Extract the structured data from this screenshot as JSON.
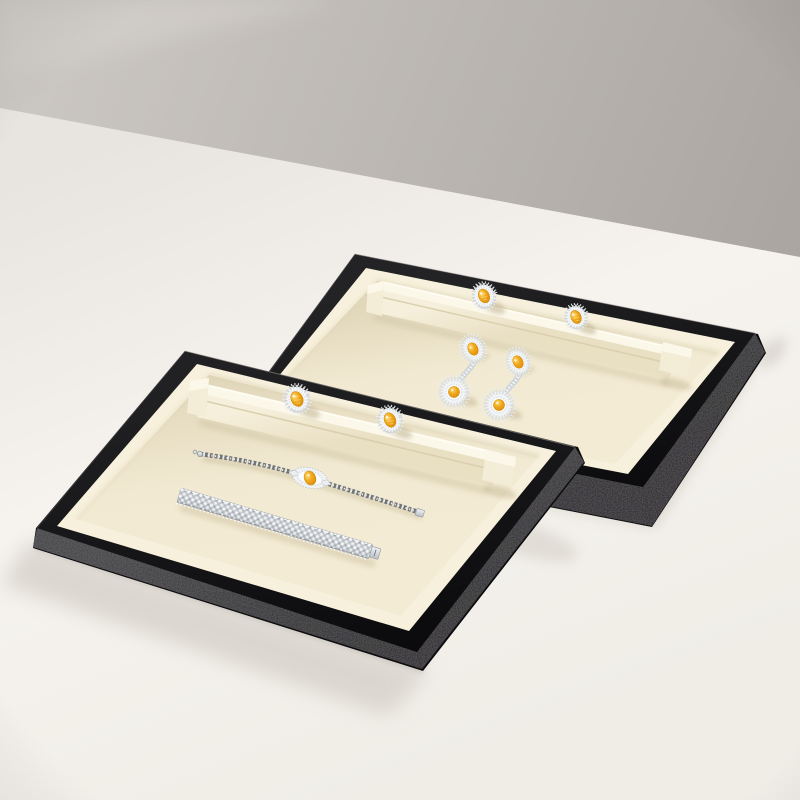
{
  "meta": {
    "content_type": "product photograph",
    "description": "Two stacked black jewelry presentation trays with ivory suede interiors resting on an off-white table against a warm gray wall. The back tray holds two citrine halo rings on a raised ring ridge and a pair of citrine diamond double-drop earrings. The front tray holds two citrine halo rings on its ring ridge, a diamond tennis bracelet with a citrine center cluster, and a wide diamond mesh bracelet.",
    "visible_text": ""
  },
  "palette": {
    "wall-light": "#cdc9c4",
    "wall-dark": "#aba6a1",
    "table-near-wall": "#e8e4df",
    "table-light": "#f6f3ee",
    "table-warm": "#f0ede7",
    "tray-black": "#111113",
    "tray-bevel-light": "#39383b",
    "tray-bevel-dark": "#1a191c",
    "lip-cream": "#f7f0dc",
    "floor-cream": "#f1e9d1",
    "floor-shadow": "#e1d7bb",
    "ridge-cream": "#f3ecd6",
    "ridge-hi": "#fbf7e9",
    "ridge-shadow": "#d4c8a8",
    "stone-yellow": "#f2ab1e",
    "stone-yellow-deep": "#c67c05",
    "stone-highlight": "#ffe083",
    "diamond-white": "#f4f6f7",
    "diamond-gray": "#c9ced3",
    "silver-light": "#f2f4f6",
    "silver-dark": "#b9bfc5",
    "shadow-warm": "#b3a47f",
    "shadow-table": "#d5d0c9"
  },
  "scene": {
    "background": {
      "wall": "warm gray studio wall",
      "surface": "off-white tabletop"
    },
    "trays": [
      {
        "position": "back right",
        "exterior": "black textured leather frame",
        "interior": "ivory suede",
        "fixture": "raised ring ridge with insert slot",
        "items": [
          "citrine halo ring",
          "citrine halo ring",
          "citrine double-drop earring",
          "citrine double-drop earring"
        ]
      },
      {
        "position": "front left, overlapping the back tray",
        "exterior": "black textured leather frame",
        "interior": "ivory suede",
        "fixture": "raised ring ridge with insert slot",
        "items": [
          "citrine halo ring",
          "citrine halo ring",
          "diamond tennis bracelet with citrine center",
          "wide diamond mesh bracelet"
        ]
      }
    ],
    "counts": {
      "trays": 2,
      "rings": 4,
      "earrings": 2,
      "bracelets": 2
    }
  }
}
